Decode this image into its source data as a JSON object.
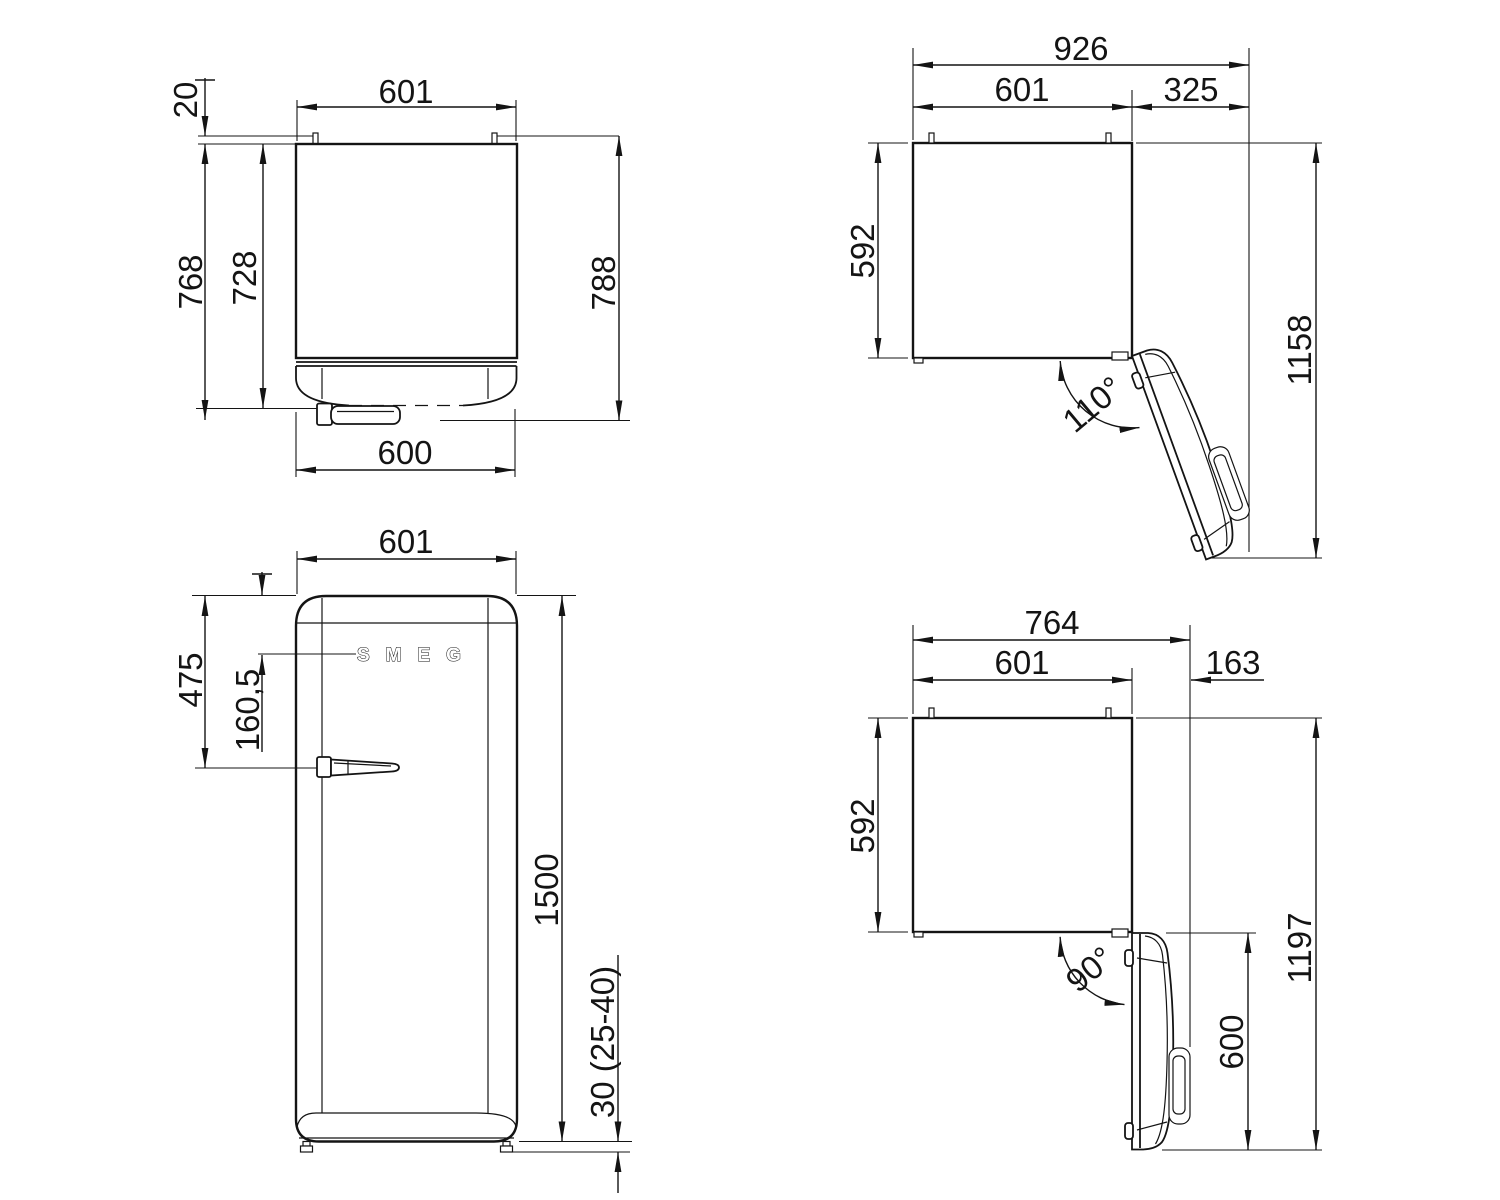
{
  "views": {
    "top": {
      "width": "601",
      "rear_gap": "20",
      "depth_to_handle": "768",
      "depth_body": "728",
      "depth_total": "788",
      "door_width": "600"
    },
    "open110": {
      "total_width": "926",
      "body_width": "601",
      "door_clearance": "325",
      "body_depth": "592",
      "total_depth": "1158",
      "angle": "110°"
    },
    "front": {
      "width": "601",
      "handle_from_top": "475",
      "logo_from_top": "160,5",
      "height": "1500",
      "feet": "30 (25-40)",
      "brand": "SMEG"
    },
    "open90": {
      "total_width": "764",
      "body_width": "601",
      "door_clearance": "163",
      "body_depth": "592",
      "total_depth": "1197",
      "door_depth": "600",
      "angle": "90°"
    }
  }
}
